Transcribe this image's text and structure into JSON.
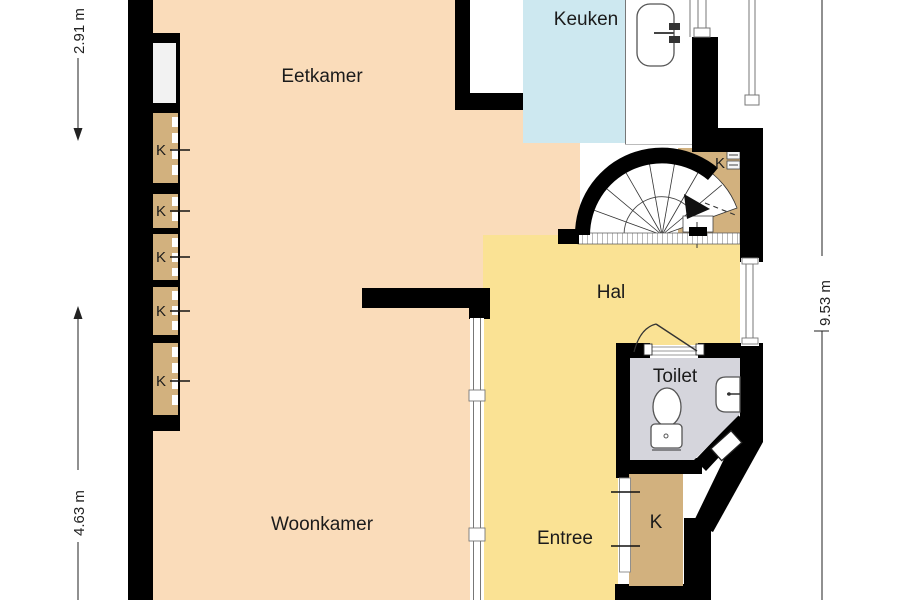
{
  "rooms": {
    "eetkamer": {
      "label": "Eetkamer"
    },
    "keuken": {
      "label": "Keuken"
    },
    "hal": {
      "label": "Hal"
    },
    "woonkamer": {
      "label": "Woonkamer"
    },
    "entree": {
      "label": "Entree"
    },
    "toilet": {
      "label": "Toilet"
    }
  },
  "closets": {
    "label": "K"
  },
  "dimensions": {
    "top_left": "2.91 m",
    "bottom_left": "4.63 m",
    "right": "9.53 m"
  },
  "colors": {
    "living": "#fadcba",
    "hall": "#fae294",
    "kitchen": "#cde8f0",
    "closet": "#d2b17e",
    "toilet_floor": "#d5d5dc",
    "wall": "#000000"
  }
}
